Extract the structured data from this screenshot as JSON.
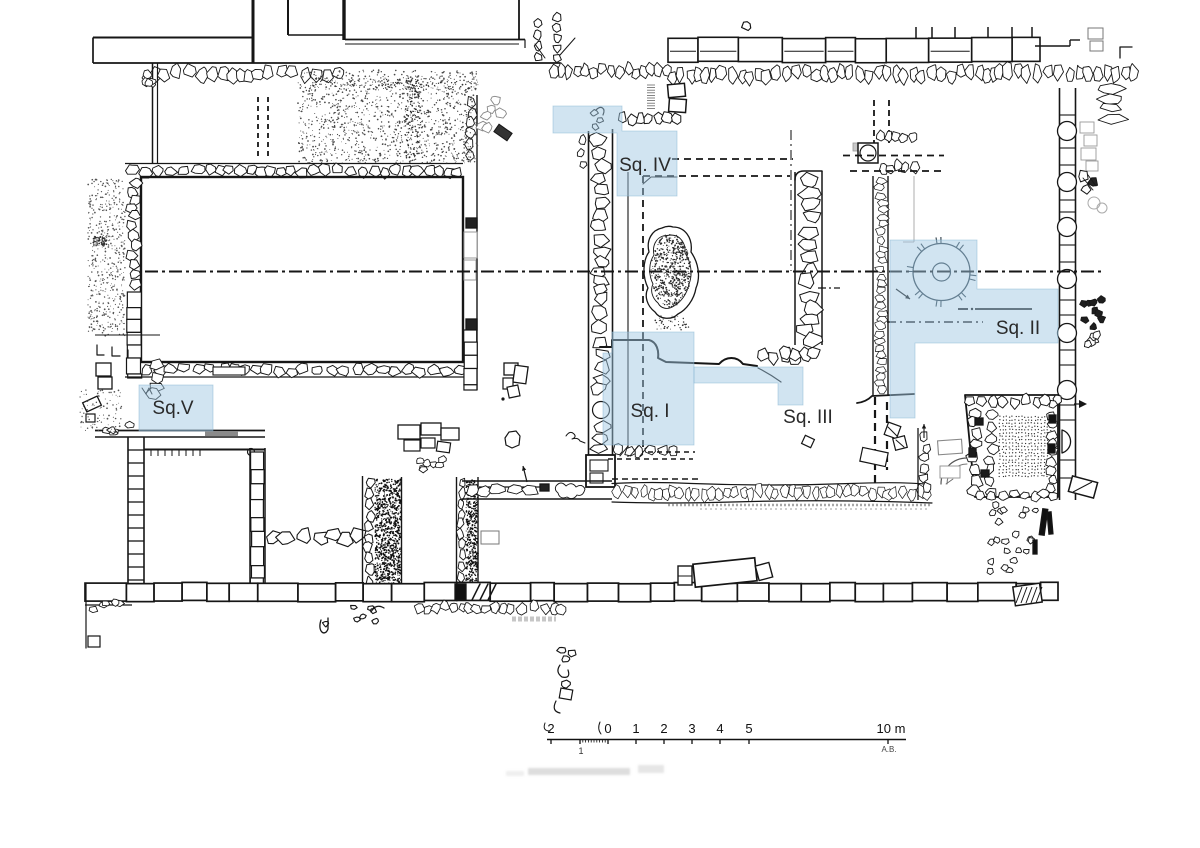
{
  "plan": {
    "title": "archaeological-excavation-plan",
    "highlight_fill": "#9fc6e2",
    "highlight_stroke": "#7fb0cf",
    "ink_color": "#1a1a1a",
    "label_color": "#2a2a2a",
    "squares": [
      {
        "id": "sq1",
        "label": "Sq. I"
      },
      {
        "id": "sq2",
        "label": "Sq. II"
      },
      {
        "id": "sq3",
        "label": "Sq. III"
      },
      {
        "id": "sq4",
        "label": "Sq. IV"
      },
      {
        "id": "sq5",
        "label": "Sq.V"
      }
    ]
  },
  "scalebar": {
    "labels_above": [
      "2",
      "0",
      "1",
      "2",
      "3",
      "4",
      "5",
      "10 m"
    ],
    "label_below": "1",
    "credit": "A.B."
  }
}
